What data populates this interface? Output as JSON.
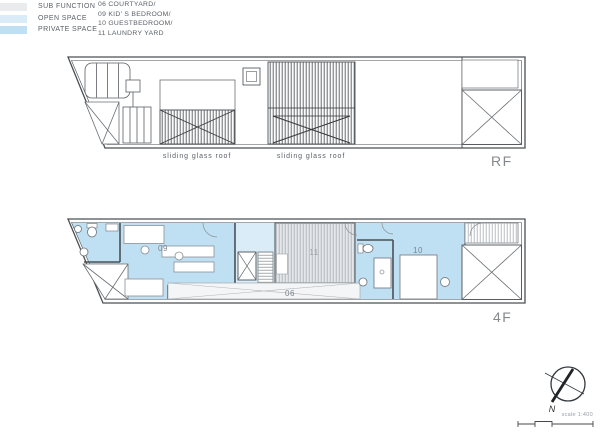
{
  "title_labels": {
    "rf": "RF",
    "f4": "4F"
  },
  "rf_plan": {
    "roof_label_left": "sliding glass roof",
    "roof_label_right": "sliding glass roof"
  },
  "f4_plan": {
    "room_09": "09",
    "room_11": "11",
    "room_10": "10",
    "room_06": "06"
  },
  "legend": {
    "categories": [
      {
        "label": "SUB FUNCTION",
        "color": "#E9EBEC"
      },
      {
        "label": "OPEN SPACE",
        "color": "#D9ECF8"
      },
      {
        "label": "PRIVATE SPACE",
        "color": "#BFE0F3"
      }
    ],
    "rooms": [
      "06 COURTYARD/",
      "09 KID' S BEDROOM/",
      "10 GUESTBEDROOM/",
      "11 LAUNDRY YARD"
    ]
  },
  "compass": {
    "north": "N",
    "scale": "scale 1:400"
  },
  "colors": {
    "private_space": "#BFE0F3",
    "open_space": "#D9ECF8",
    "sub_function": "#E9EBEC",
    "line": "#4B5055"
  }
}
